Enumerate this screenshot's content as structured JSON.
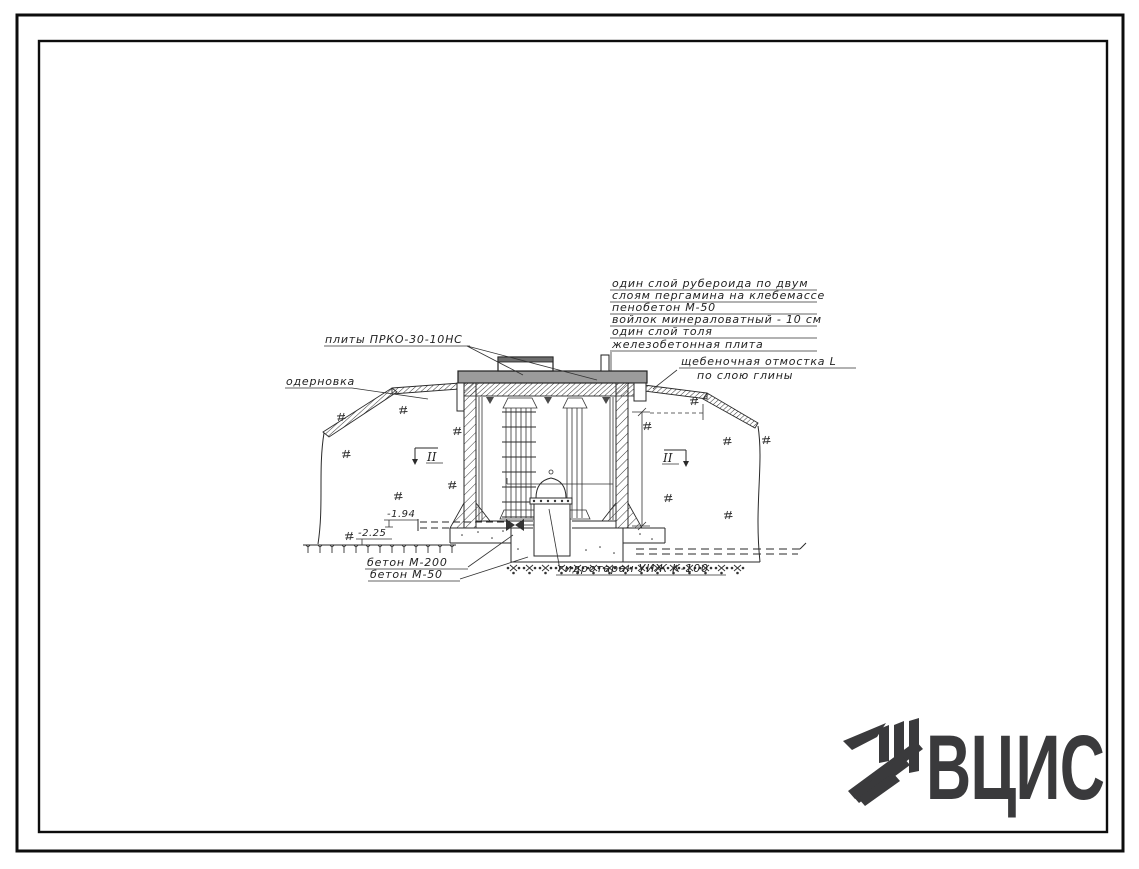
{
  "colors": {
    "ink": "#262626",
    "slab_gray": "#9b9b9b",
    "logo": "#3a3a3c"
  },
  "drawing": {
    "roof_note_lines": [
      "один слой рубероида по двум",
      "слоям пергамина на клебемассе",
      "пенобетон М-50",
      "войлок минераловатный - 10 см",
      "один слой толя",
      "железобетонная плита"
    ],
    "labels": {
      "plates": "плиты ПРКО-30-10НС",
      "sod": "одерновка",
      "apron_line1": "щебеночная отмостка L",
      "apron_line2": "по слою глины",
      "concrete_upper": "бетон М-200",
      "concrete_lower": "бетон М-50",
      "hydraulic_ram": "гидротаран УИЖ К-100"
    },
    "elevations": {
      "pipe": "-1.94",
      "ground": "-2.25"
    },
    "sections": {
      "left": "II",
      "right": "II"
    }
  },
  "logo": {
    "text": "ВЦИС"
  }
}
